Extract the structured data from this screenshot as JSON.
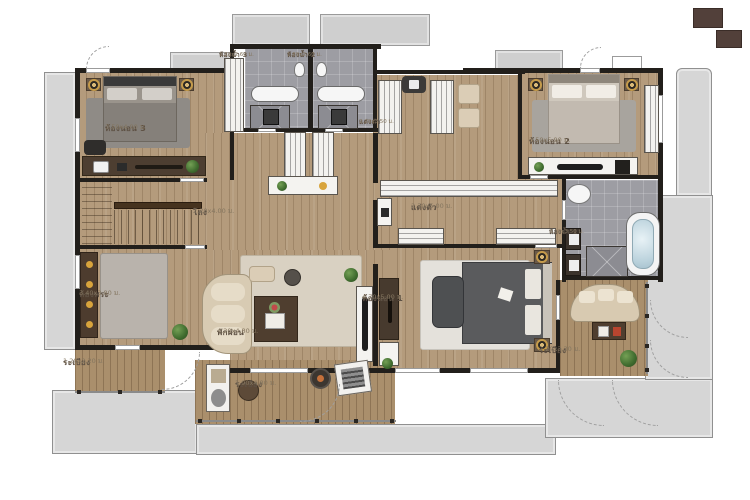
{
  "plan": {
    "type": "floor-plan",
    "language": "th",
    "rooms": [
      {
        "id": "bedroom-3",
        "label": "ห้องนอน 3",
        "dims": "3.50x4.00 ม."
      },
      {
        "id": "bathroom-3",
        "label": "ห้องน้ำ 3",
        "dims": "1.20x2.60 ม."
      },
      {
        "id": "bathroom-2",
        "label": "ห้องน้ำ 2",
        "dims": "1.80x2.60 ม."
      },
      {
        "id": "dressing-top",
        "label": "แต่งตัว",
        "dims": "2.20x3.50 ม."
      },
      {
        "id": "bedroom-2",
        "label": "ห้องนอน 2",
        "dims": "3.50x5.90 ม."
      },
      {
        "id": "hall",
        "label": "โถง",
        "dims": "2.20x4.00 ม."
      },
      {
        "id": "walkin-closet",
        "label": "แต่งตัว",
        "dims": "2.30x5.00 ม."
      },
      {
        "id": "bathroom-1",
        "label": "ห้องน้ำ 1",
        "dims": "3.10x3.50 ม."
      },
      {
        "id": "prayer-room",
        "label": "ห้องพระ",
        "dims": "3.40x3.80 ม."
      },
      {
        "id": "family-area",
        "label": "พักผ่อน",
        "dims": "4.20x4.80 ม."
      },
      {
        "id": "bedroom-1",
        "label": "ห้องนอน 1",
        "dims": "4.70x5.00 ม."
      },
      {
        "id": "balcony-left",
        "label": "ระเบียง",
        "dims": "1.20x2.20 ม."
      },
      {
        "id": "balcony-center",
        "label": "ระเบียง",
        "dims": "1.90x4.80 ม."
      },
      {
        "id": "balcony-right",
        "label": "ระเบียง",
        "dims": "2.20x3.30 ม."
      }
    ],
    "colors": {
      "wall": "#221f1b",
      "wood_floor": "#b49b7c",
      "balcony_wood": "#aa8f6c",
      "bathroom_tile": "#9d9da3",
      "outdoor_deck": "#d6d6d6",
      "accent_gold": "#c59b4b",
      "label_text": "#5e5144"
    }
  }
}
